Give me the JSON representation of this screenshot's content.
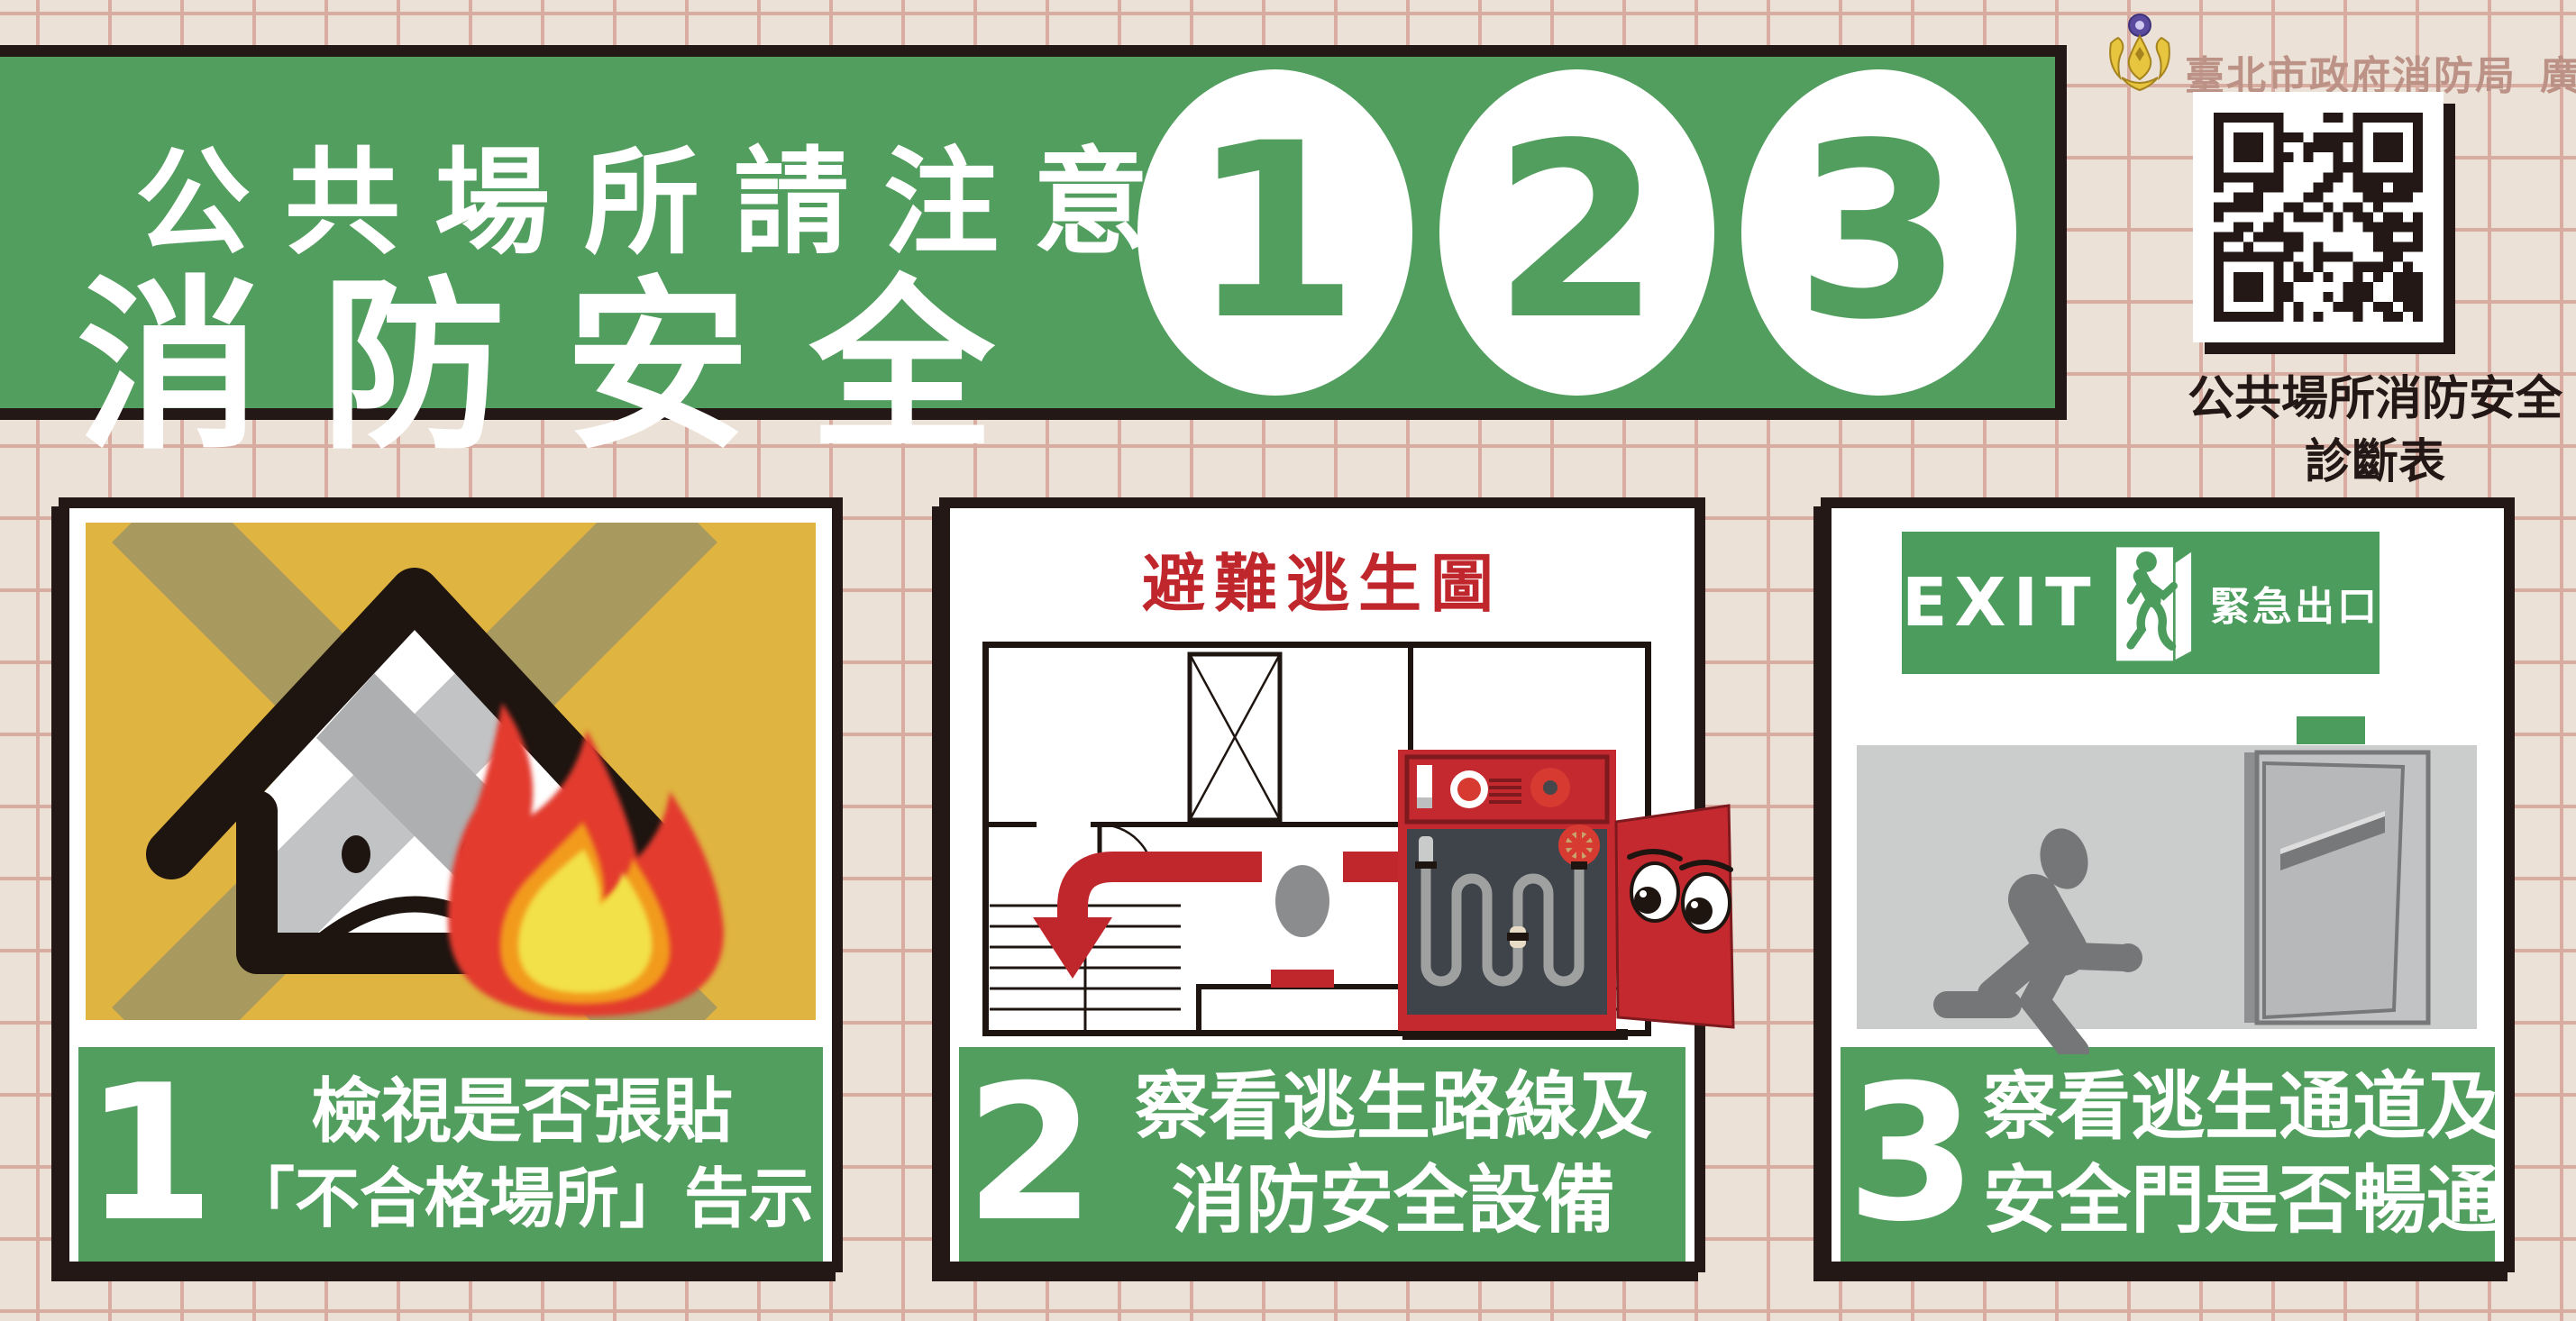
{
  "poster": {
    "banner": {
      "top_line": "公共場所請注意",
      "main_line": "消防安全",
      "step_numbers": [
        "1",
        "2",
        "3"
      ]
    },
    "publisher": {
      "logo": "taipei-fire-department-phoenix-emblem",
      "agency": "臺北市政府消防局",
      "ad_tag": "廣告",
      "qr_caption_line1": "公共場所消防安全",
      "qr_caption_line2": "診斷表"
    },
    "steps": [
      {
        "number": "1",
        "line1": "檢視是否張貼",
        "line2": "「不合格場所」告示",
        "illustration": "crossed-out-burning-house"
      },
      {
        "number": "2",
        "line1": "察看逃生路線及",
        "line2": "消防安全設備",
        "map_title": "避難逃生圖",
        "illustration": "evacuation-map-and-fire-hose-cabinet"
      },
      {
        "number": "3",
        "line1": "察看逃生通道及",
        "line2": "安全門是否暢通",
        "exit_word": "EXIT",
        "exit_label": "緊急出口",
        "illustration": "exit-sign-corridor-and-fire-door"
      }
    ],
    "colors": {
      "background": "#EBE1D6",
      "grid_line": "#D9ACA1",
      "green": "#529E5F",
      "ink": "#231815",
      "accent_red": "#C0272D",
      "panel_yellow": "#DFB440",
      "dusty_rose": "#BC9287",
      "gold": "#E8C53E"
    }
  }
}
